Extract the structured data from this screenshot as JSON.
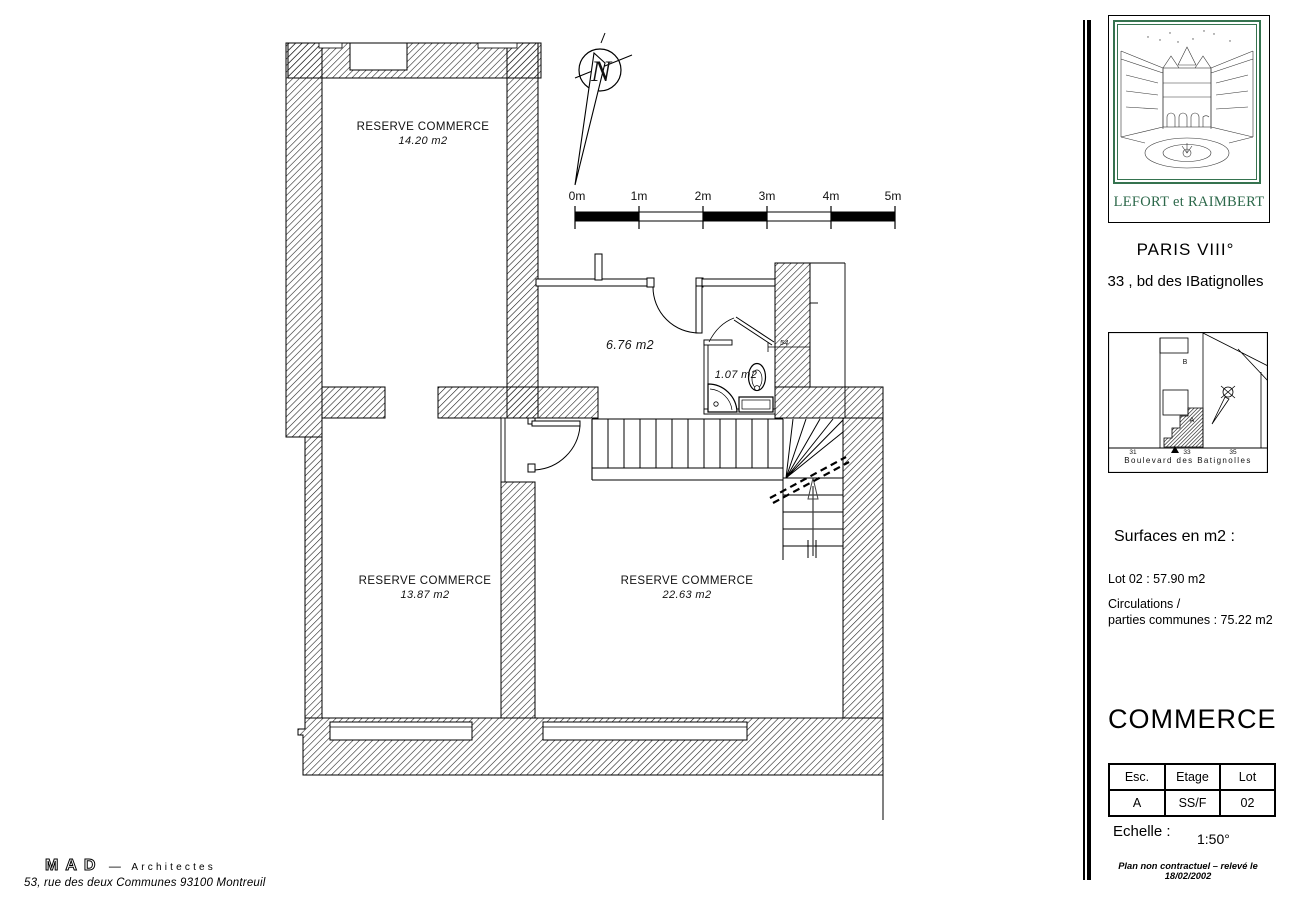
{
  "plan": {
    "north_letter": "N",
    "scale_bar": {
      "labels": [
        "0m",
        "1m",
        "2m",
        "3m",
        "4m",
        "5m"
      ]
    },
    "rooms": {
      "reserve1": {
        "name": "RESERVE COMMERCE",
        "area": "14.20  m2"
      },
      "reserve2": {
        "name": "RESERVE COMMERCE",
        "area": "13.87 m2"
      },
      "reserve3": {
        "name": "RESERVE COMMERCE",
        "area": "22.63 m2"
      },
      "hall": {
        "area": "6.76 m2"
      },
      "wc": {
        "area": "1.07 m2"
      }
    },
    "dims": {
      "door_width": "54"
    }
  },
  "sidebar": {
    "logo_caption": "LEFORT et RAIMBERT",
    "city": "PARIS VIII°",
    "address": "33 , bd des IBatignolles",
    "map": {
      "street": "Boulevard des Batignolles",
      "numbers": [
        "31",
        "33",
        "35"
      ],
      "units": {
        "a": "A",
        "b": "B"
      }
    },
    "surfaces": {
      "title": "Surfaces en m2 :",
      "lot": "Lot 02 : 57.90 m2",
      "line1": "Circulations /",
      "line2": "parties communes : 75.22 m2"
    },
    "program": "COMMERCE",
    "table": {
      "headers": [
        "Esc.",
        "Etage",
        "Lot"
      ],
      "row": [
        "A",
        "SS/F",
        "02"
      ]
    },
    "scale": {
      "label": "Echelle :",
      "value": "1:50°"
    },
    "disclaimer": "Plan non contractuel – relevé le 18/02/2002"
  },
  "footer": {
    "firm": "MAD",
    "separator": "—",
    "firm_type": "Architectes",
    "address": "53,  rue  des  deux  Communes  93100  Montreuil"
  },
  "colors": {
    "accent_green": "#35734f",
    "ink": "#000000"
  }
}
